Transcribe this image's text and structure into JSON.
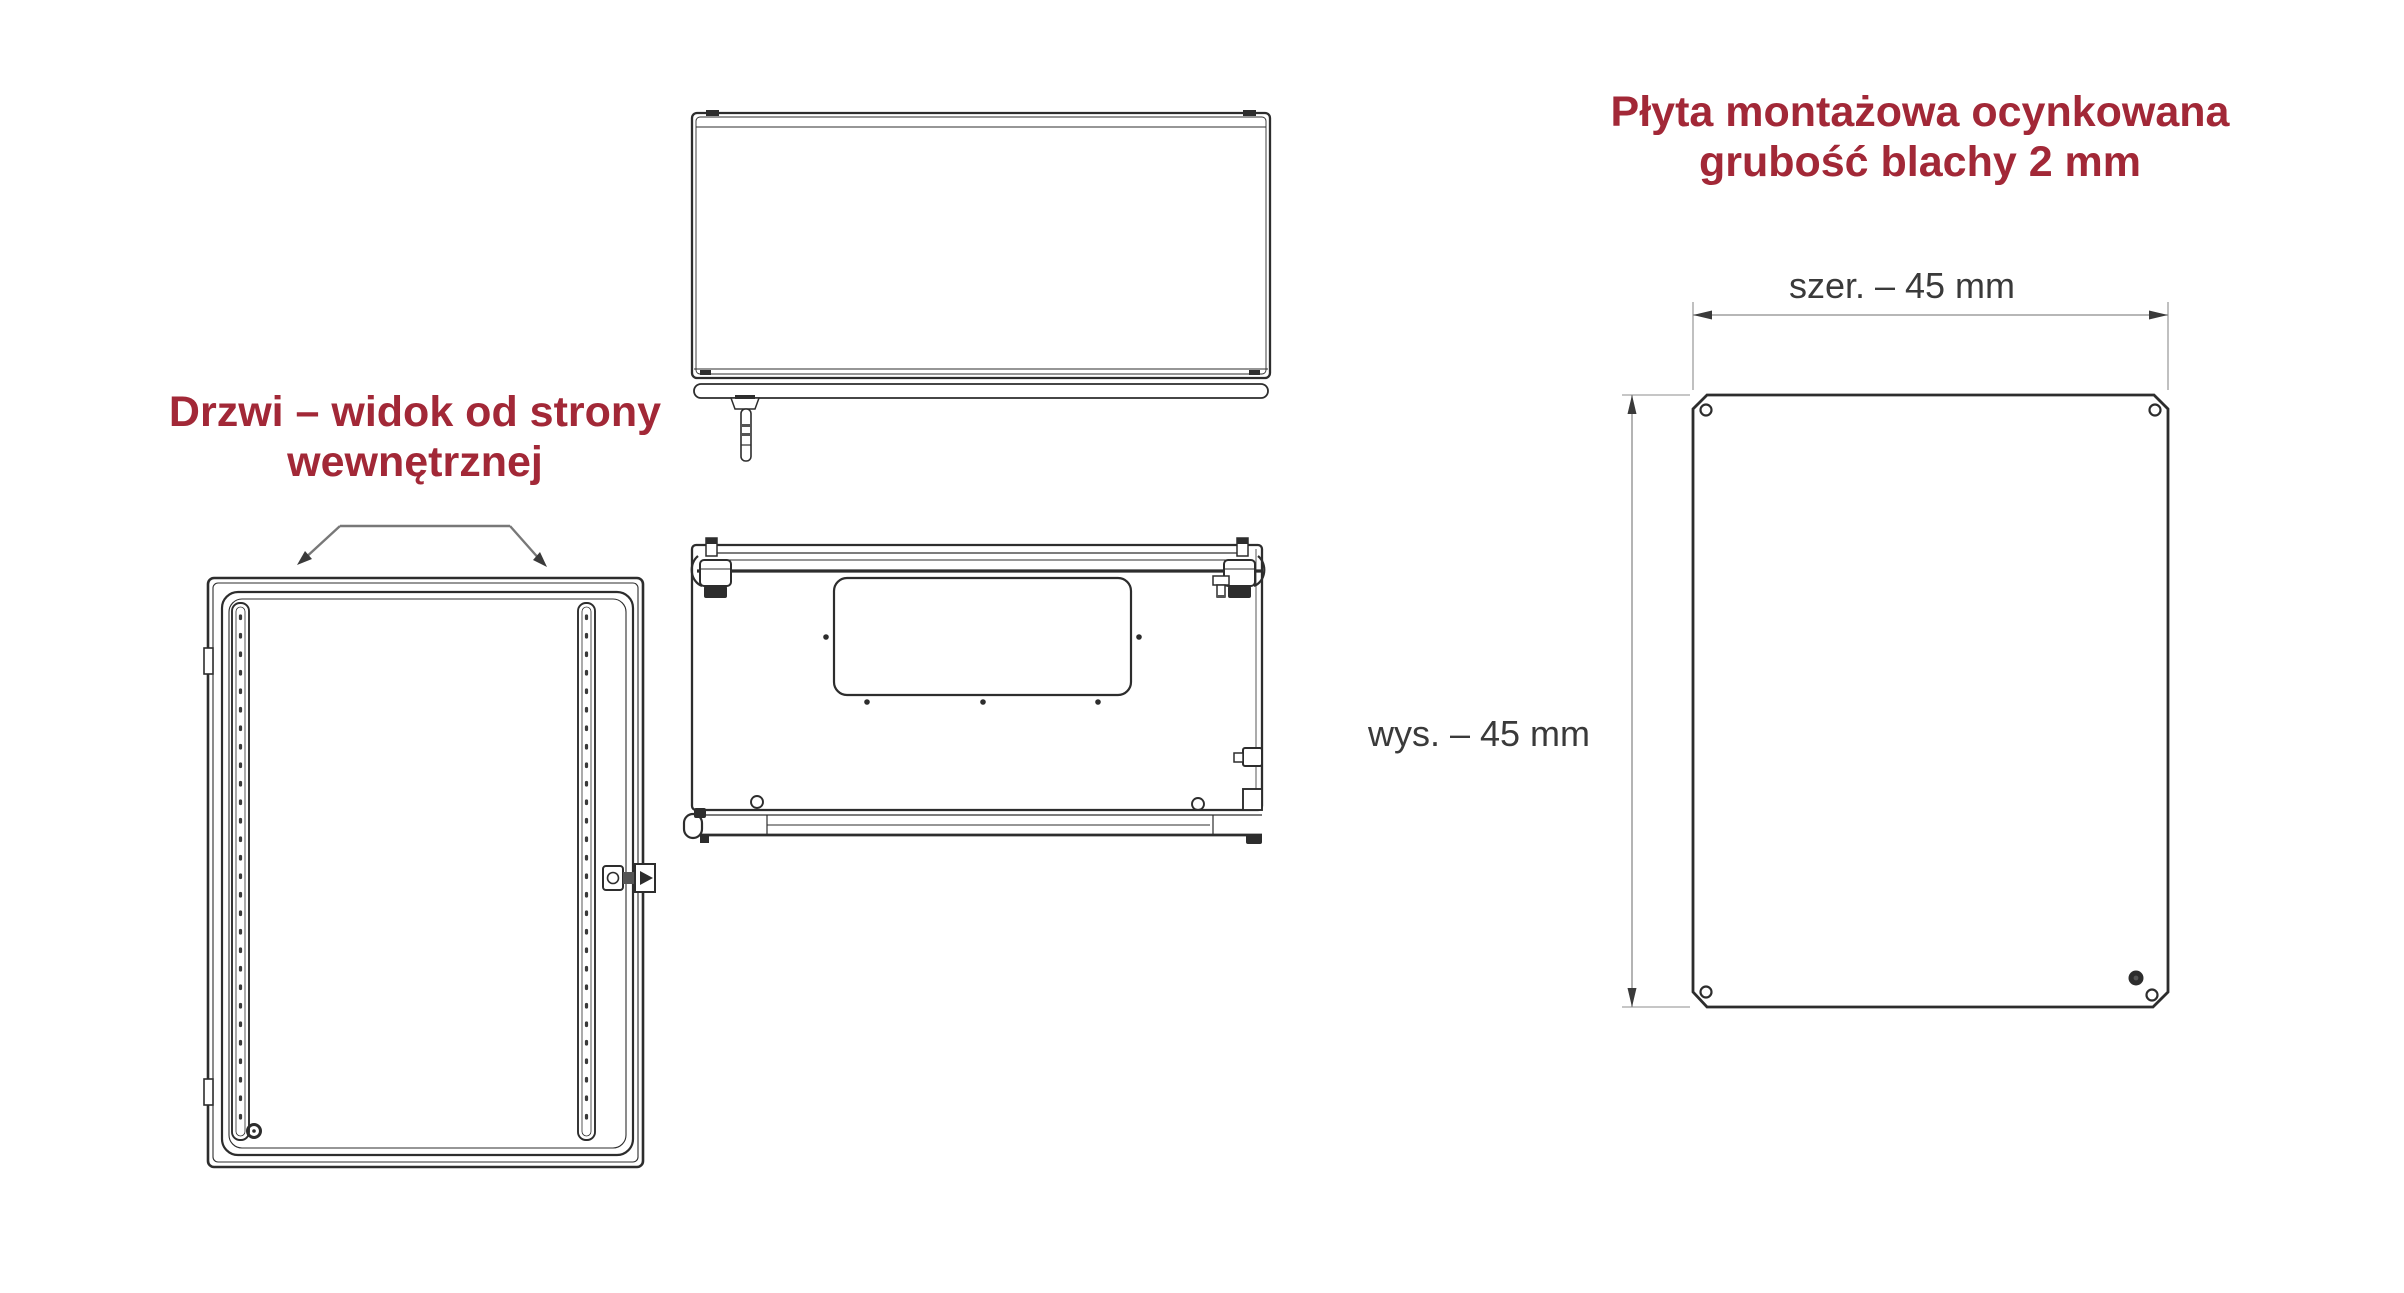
{
  "theme": {
    "background": "#ffffff",
    "accent": "#a22837",
    "line": "#2d2d2d",
    "dim_line": "#8c8c8c",
    "dim_text": "#3a3a3a"
  },
  "labels": {
    "door_view_line1": "Drzwi – widok od strony",
    "door_view_line2": "wewnętrznej",
    "plate_title_line1": "Płyta montażowa ocynkowana",
    "plate_title_line2": "grubość blachy 2 mm",
    "dim_width": "szer. – 45 mm",
    "dim_height": "wys. – 45 mm"
  }
}
